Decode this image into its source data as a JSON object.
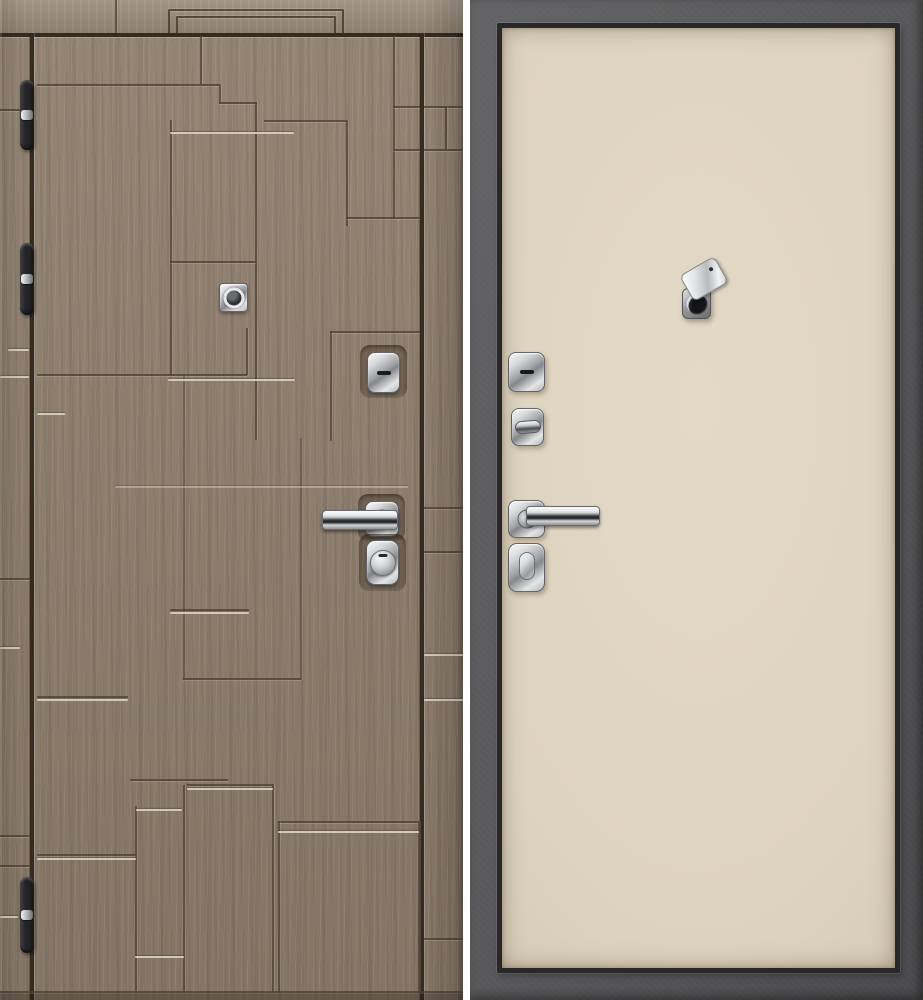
{
  "scene": {
    "left_panel_alt": "Entry door, exterior side: brown woodgrain finish with stepped rectangular grooves and silver accent lines, three black barrel hinges, square chrome cylinder plate, keyhole escutcheon, chrome lever handle and round lock escutcheon",
    "right_panel_alt": "Entry door, interior side: plain cream flat panel set in a dark grey steel frame, chrome keyhole escutcheon, thumbturn lock, chrome lever handle, oval thumbturn escutcheon and an open swivel peephole cover",
    "hinge_count": 3,
    "text_content": "none"
  },
  "colors": {
    "page_bg": "#ffffff",
    "wood_base": "#8e7e6d",
    "wood_band": "#968878",
    "groove_dark": "#4e4134",
    "accent_silver": "#d9d2c3",
    "edge_gap": "#352c21",
    "hinge_black": "#232326",
    "frame_gray": "#5d5d5f",
    "frame_gray_dark": "#4a4a4c",
    "leaf_outline": "#28282a",
    "panel_cream": "#ddd4c0",
    "panel_cream_edge": "#cbc1aa",
    "chrome_light": "#f5f6f7",
    "chrome_mid": "#b7b8bb",
    "chrome_dark": "#6f7073",
    "lens_dark": "#141416"
  }
}
